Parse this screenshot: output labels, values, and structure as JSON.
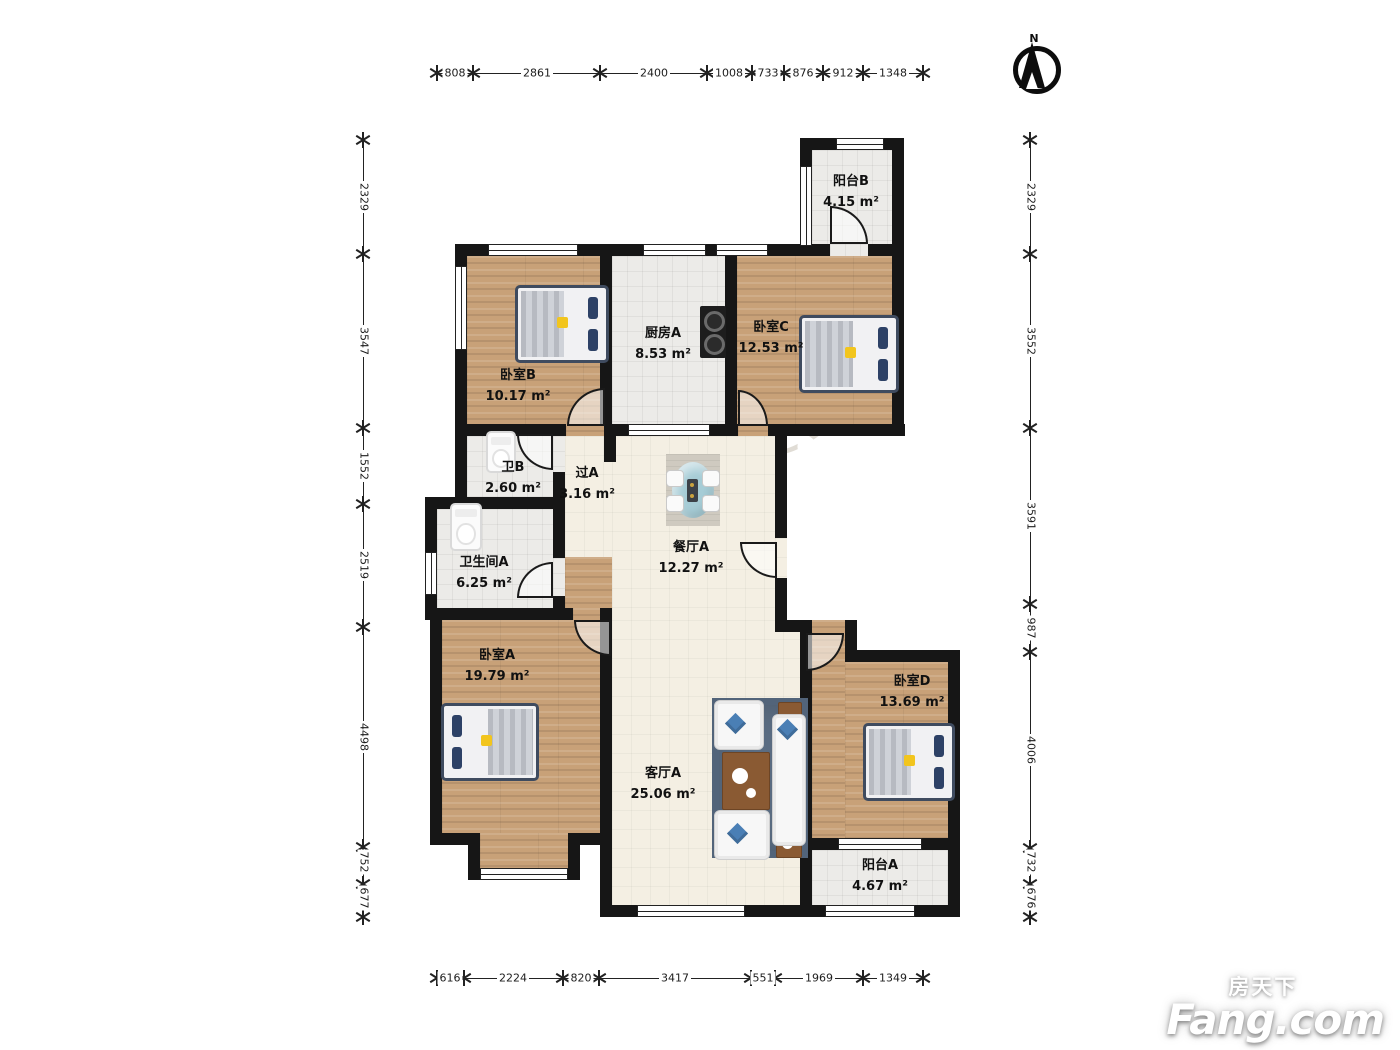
{
  "compass": {
    "label": "N"
  },
  "rooms": [
    {
      "name": "阳台B",
      "area": "4.15 m²"
    },
    {
      "name": "厨房A",
      "area": "8.53 m²"
    },
    {
      "name": "卧室C",
      "area": "12.53 m²"
    },
    {
      "name": "卧室B",
      "area": "10.17 m²"
    },
    {
      "name": "卫B",
      "area": "2.60 m²"
    },
    {
      "name": "过A",
      "area": "3.16 m²"
    },
    {
      "name": "餐厅A",
      "area": "12.27 m²"
    },
    {
      "name": "卫生间A",
      "area": "6.25 m²"
    },
    {
      "name": "卧室A",
      "area": "19.79 m²"
    },
    {
      "name": "客厅A",
      "area": "25.06 m²"
    },
    {
      "name": "卧室D",
      "area": "13.69 m²"
    },
    {
      "name": "阳台A",
      "area": "4.67 m²"
    }
  ],
  "dimensions": {
    "top": [
      "808",
      "2861",
      "2400",
      "1008",
      "733",
      "876",
      "912",
      "1348"
    ],
    "bottom": [
      "616",
      "2224",
      "820",
      "3417",
      "551",
      "1969",
      "1349"
    ],
    "left": [
      "2329",
      "3547",
      "1552",
      "2519",
      "4498",
      "752",
      "677"
    ],
    "right": [
      "2329",
      "3552",
      "3591",
      "987",
      "4006",
      "732",
      "676"
    ]
  },
  "watermark": {
    "text": "我爱我家"
  },
  "logo": {
    "cn": "房天下",
    "en": "Fang.com"
  },
  "colors": {
    "wall": "#161616",
    "wood": "#c8a178",
    "tile": "#ecebe8",
    "cream": "#f4efe3",
    "accent_rug": "#5b6d83",
    "table_teal": "#a6ccd6"
  }
}
